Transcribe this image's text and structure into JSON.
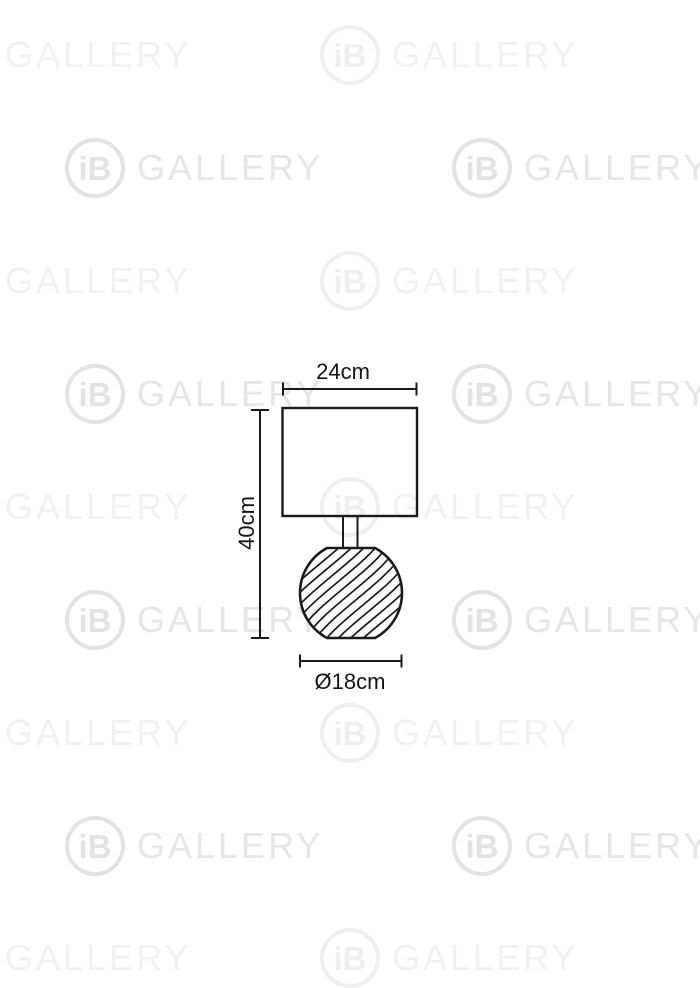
{
  "watermark": {
    "brand_short": "iB",
    "brand": "GALLERY"
  },
  "diagram": {
    "product": "table-lamp-dimension-drawing",
    "shade_width_label": "24cm",
    "total_height_label": "40cm",
    "base_diameter_label": "Ø18cm"
  },
  "colors": {
    "background": "#ffffff",
    "line": "#1a1a1a",
    "watermark": "#e6e6e6"
  }
}
